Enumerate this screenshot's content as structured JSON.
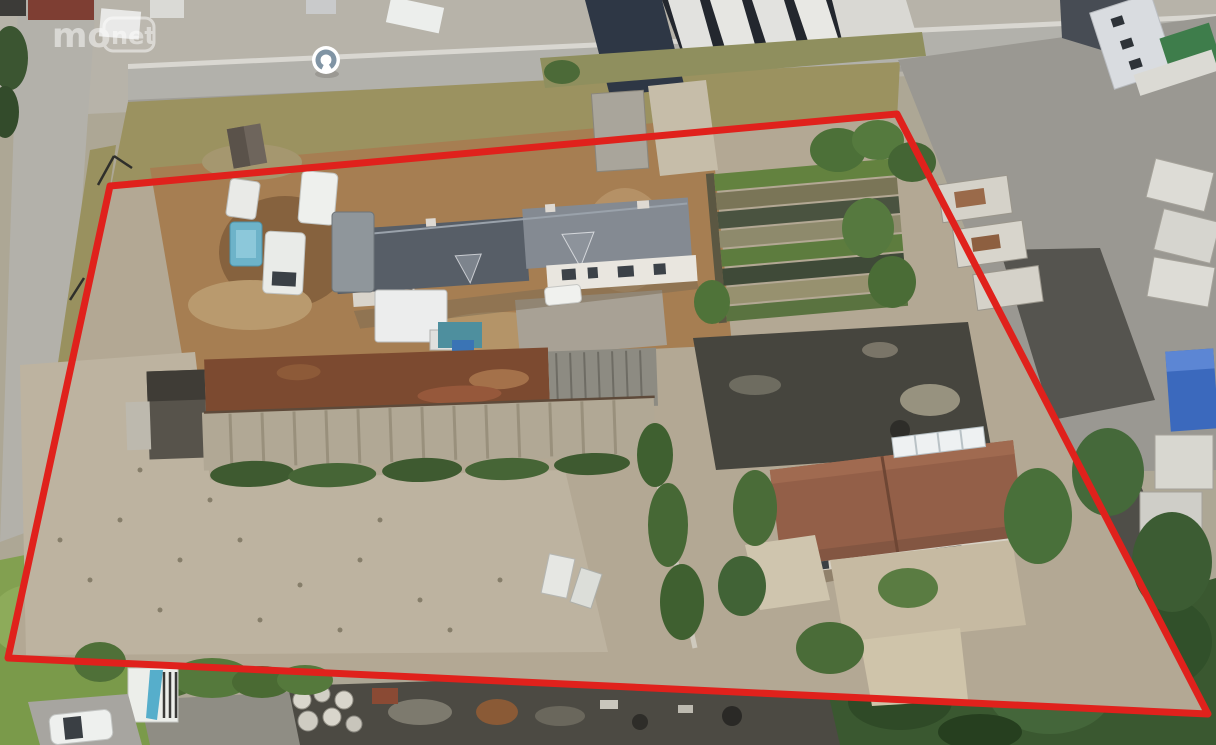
{
  "meta": {
    "view": "aerial-photo",
    "subject": "industrial-property-with-outlined-parcel"
  },
  "watermark": {
    "part1": "mo",
    "part2": "net",
    "color": "#ffffff",
    "opacity": "0.5"
  },
  "boundary": {
    "points": "110,186 897,114 1208,714 8,658",
    "color": "#e0211c",
    "stroke_width": "7"
  },
  "streetview_icon": {
    "disc_color": "#ffffff",
    "ring_color": "#8094a4"
  },
  "palette": {
    "road": "#b2b1ab",
    "asphalt_yard": "#9a9892",
    "gravel_court": "#b6ad9b",
    "dirt_court": "#a67e52",
    "slate_roof": "#575e67",
    "rust_roof": "#7c4a30",
    "tile_roof": "#935f48",
    "grass": "#82a050",
    "tree": "#3f5e31",
    "blue_container": "#3b69bd"
  }
}
